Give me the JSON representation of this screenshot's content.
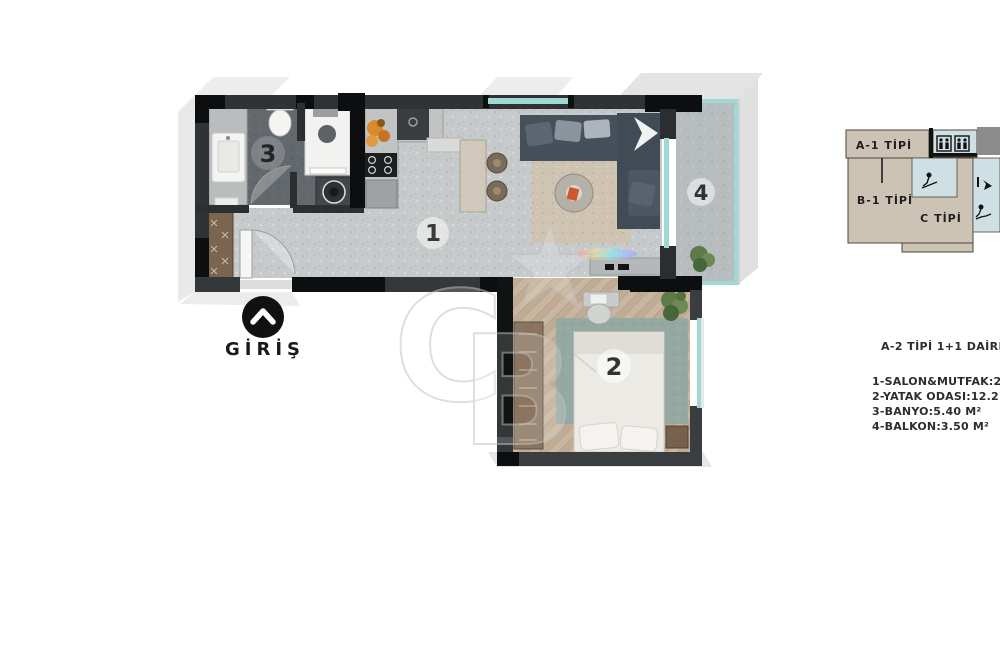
{
  "entrance": {
    "label": "GİRİŞ"
  },
  "rooms": {
    "living": "1",
    "bedroom": "2",
    "bathroom": "3",
    "balcony": "4"
  },
  "key_plan": {
    "unit_a1": "A-1 TİPİ",
    "unit_b1": "B-1 TİPİ",
    "unit_c": "C TİPİ"
  },
  "info": {
    "title": "A-2 TİPİ 1+1 DAİRE",
    "lines": [
      "1-SALON&MUTFAK:2",
      "2-YATAK ODASI:12.2",
      "3-BANYO:5.40 M²",
      "4-BALKON:3.50 M²"
    ]
  },
  "colors": {
    "wall_dark": "#2f3336",
    "wall_black": "#0d0e0f",
    "window_glass": "#9fd8d4",
    "floor_light": "#c6cacb",
    "floor_bath": "#63686d",
    "floor_wood": "#c8b6a1",
    "rug_teal": "#94a9a1",
    "rug_beige": "#cfc3b1",
    "keyplan_beige": "#cdc3b5",
    "keyplan_blue": "#cfe0e5",
    "plant_green": "#5d7a48",
    "accent_orange": "#cc5a2a"
  }
}
